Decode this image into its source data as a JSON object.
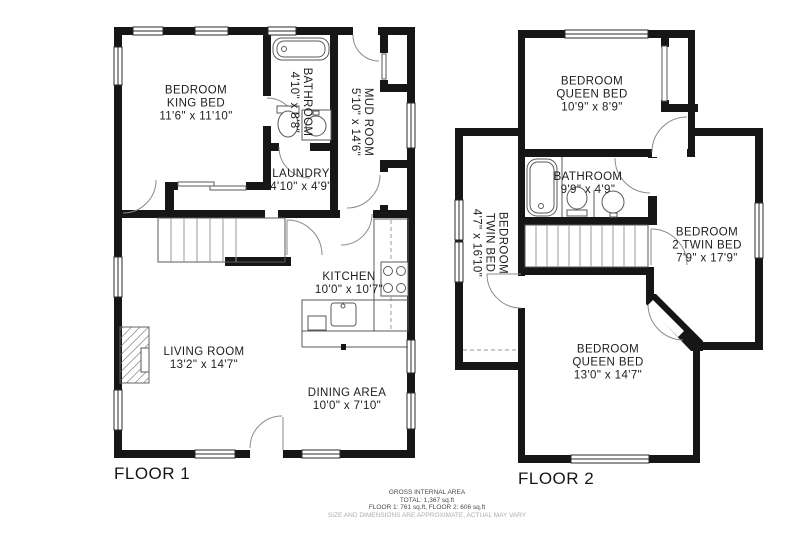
{
  "colors": {
    "wall": "#161616",
    "text": "#1d1d1d",
    "muted_text": "#aeada5"
  },
  "floor1": {
    "label": "FLOOR 1",
    "rooms": {
      "king_bedroom": {
        "lines": [
          "BEDROOM",
          "KING BED",
          "11'6\" x 11'10\""
        ]
      },
      "bathroom": {
        "lines": [
          "BATHROOM",
          "4'10\" x 8'8\""
        ]
      },
      "mud_room": {
        "lines": [
          "MUD ROOM",
          "5'10\" x 14'6\""
        ]
      },
      "laundry": {
        "lines": [
          "LAUNDRY",
          "4'10\" x 4'9\""
        ]
      },
      "kitchen": {
        "lines": [
          "KITCHEN",
          "10'0\" x 10'7\""
        ]
      },
      "living_room": {
        "lines": [
          "LIVING ROOM",
          "13'2\" x 14'7\""
        ]
      },
      "dining_area": {
        "lines": [
          "DINING AREA",
          "10'0\" x 7'10\""
        ]
      }
    }
  },
  "floor2": {
    "label": "FLOOR 2",
    "rooms": {
      "queen_bedroom_upper": {
        "lines": [
          "BEDROOM",
          "QUEEN BED",
          "10'9\" x 8'9\""
        ]
      },
      "bathroom": {
        "lines": [
          "BATHROOM",
          "9'9\" x 4'9\""
        ]
      },
      "twin_bedroom": {
        "lines": [
          "BEDROOM",
          "TWIN BED",
          "4'7\" x 16'10\""
        ]
      },
      "twin2_bedroom": {
        "lines": [
          "BEDROOM",
          "2 TWIN BED",
          "7'9\" x 17'9\""
        ]
      },
      "queen_bedroom_lower": {
        "lines": [
          "BEDROOM",
          "QUEEN BED",
          "13'0\" x 14'7\""
        ]
      }
    }
  },
  "footer": {
    "line1": "GROSS INTERNAL AREA",
    "line2": "TOTAL: 1,367 sq.ft",
    "line3": "FLOOR 1: 761 sq.ft, FLOOR 2: 606 sq.ft",
    "line4": "SIZE AND DIMENSIONS ARE APPROXIMATE, ACTUAL MAY VARY"
  }
}
